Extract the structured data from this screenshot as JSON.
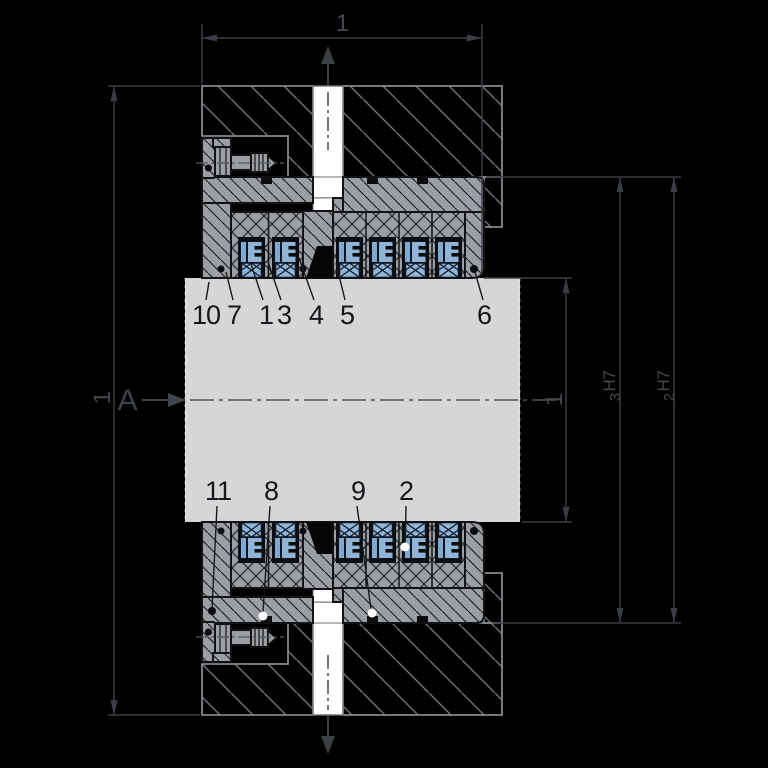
{
  "drawing": {
    "kind": "technical-cross-section",
    "background": "#000000",
    "palette": {
      "part_gray": "#9b9fa3",
      "shaft_gray": "#d5d6d7",
      "seal_blue": "#8fb4d6",
      "seal_blue_dark": "#7fa9cf",
      "outline_black": "#121212",
      "housing_line": "#82878d",
      "housing_hatch": "#6f747a",
      "dim_line": "#3a3e44",
      "dim_text": "#43474e",
      "callout_text": "#16171a",
      "port_white": "#ffffff"
    },
    "section_label": "A",
    "dimensions": {
      "top_length": "1",
      "outer_diameter": "1",
      "shaft_diameter": "1",
      "bore3": {
        "num": "3",
        "tol": "H7"
      },
      "bore2": {
        "num": "2",
        "tol": "H7"
      }
    },
    "callouts_top": [
      {
        "label": "10"
      },
      {
        "label": "7"
      },
      {
        "label": "1"
      },
      {
        "label": "3"
      },
      {
        "label": "4"
      },
      {
        "label": "5"
      },
      {
        "label": "6"
      }
    ],
    "callouts_bottom": [
      {
        "label": "11"
      },
      {
        "label": "8"
      },
      {
        "label": "9"
      },
      {
        "label": "2"
      }
    ]
  }
}
